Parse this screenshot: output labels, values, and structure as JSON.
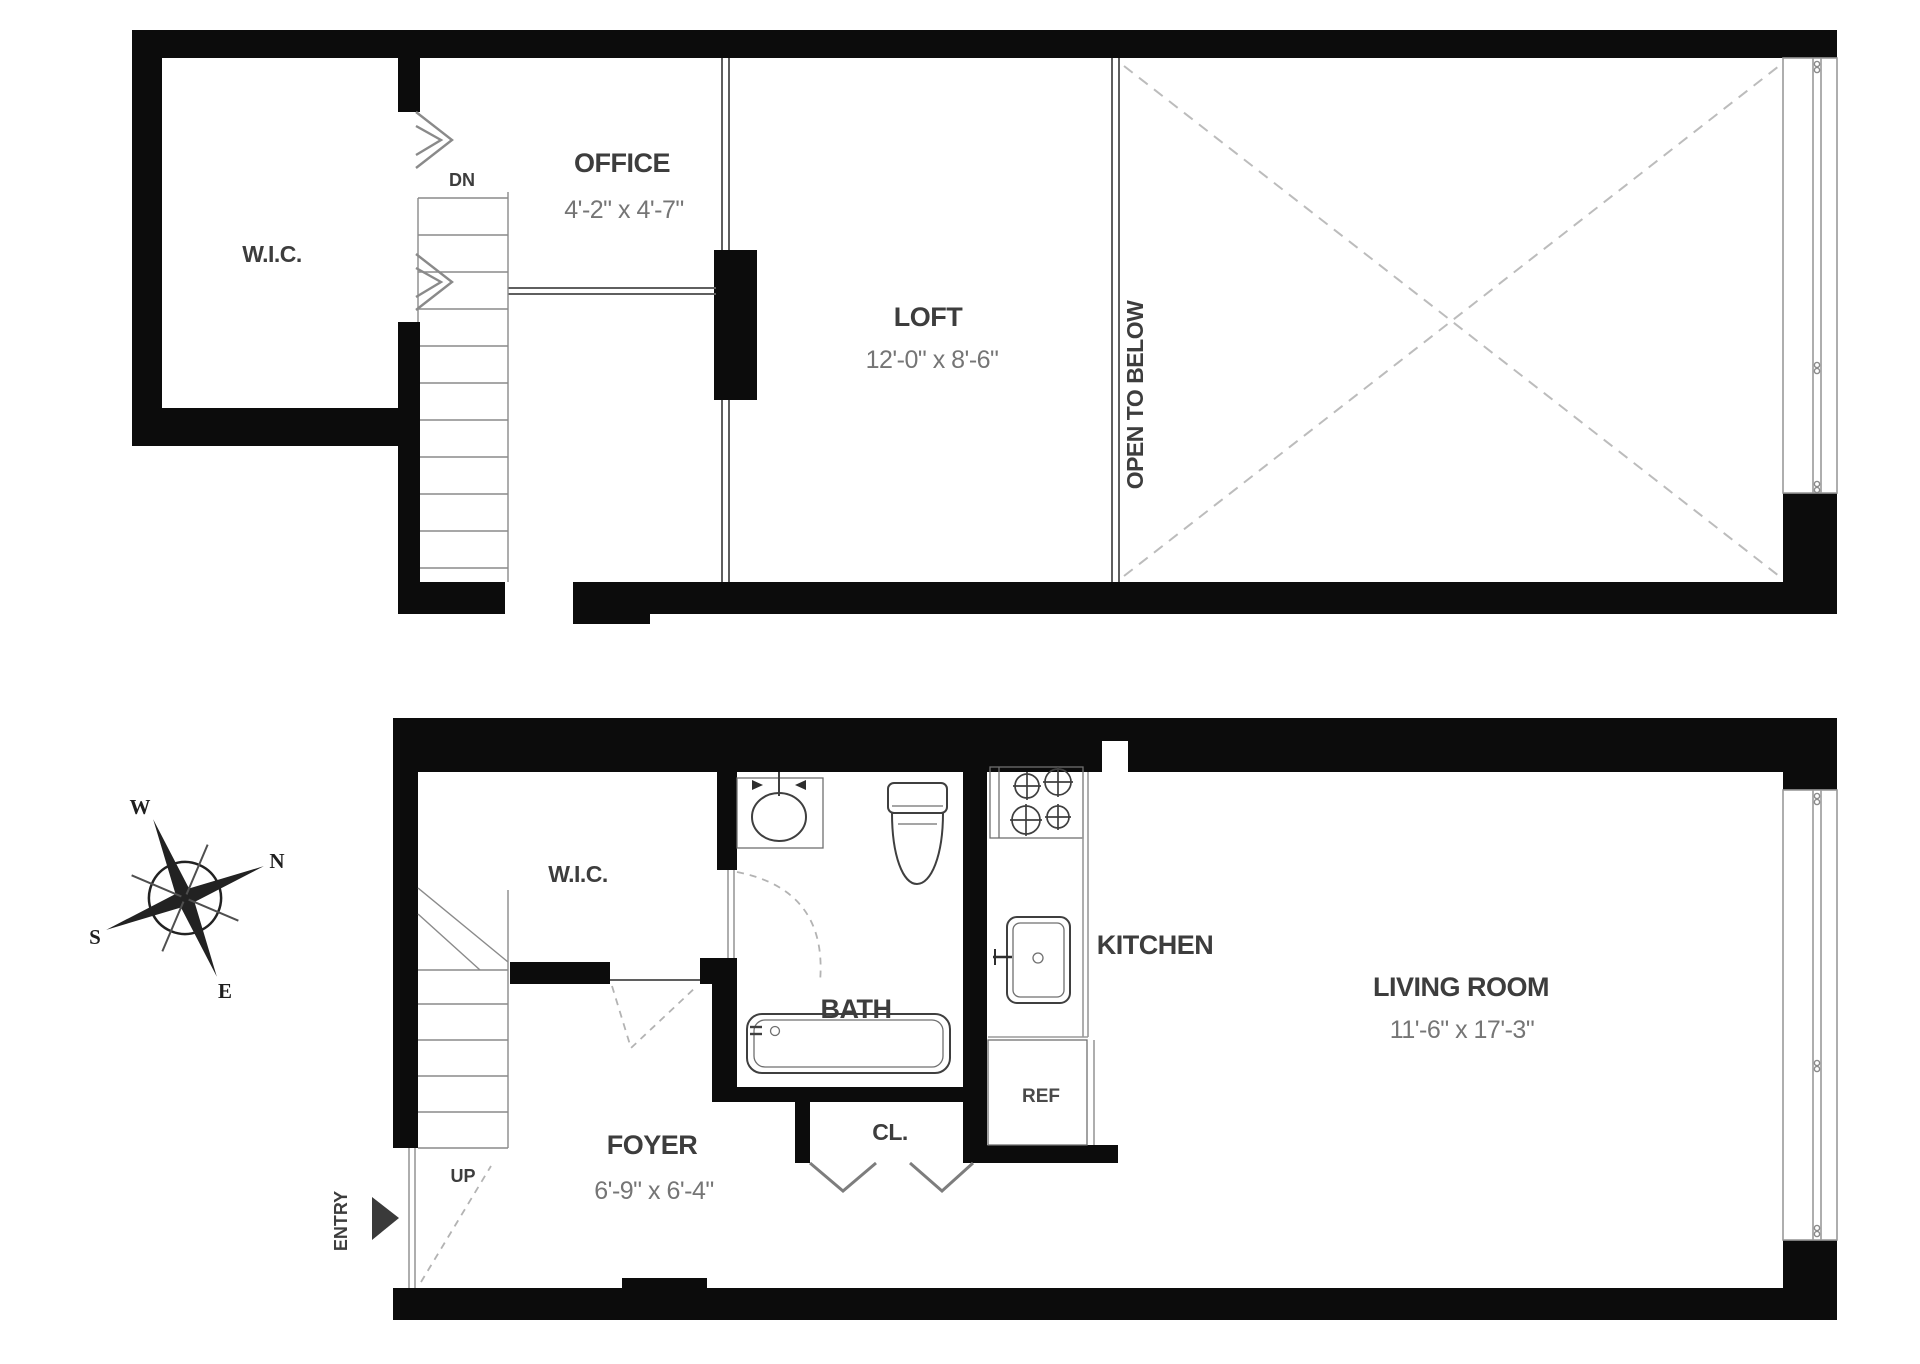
{
  "title": "Two-level apartment floor plan",
  "upper_floor": {
    "rooms": {
      "wic": {
        "label": "W.I.C."
      },
      "office": {
        "label": "OFFICE",
        "dimensions": "4'-2\" x 4'-7\""
      },
      "loft": {
        "label": "LOFT",
        "dimensions": "12'-0\" x 8'-6\""
      },
      "open_to_below": {
        "label": "OPEN TO BELOW"
      }
    },
    "stairs": {
      "label": "DN"
    }
  },
  "lower_floor": {
    "rooms": {
      "wic": {
        "label": "W.I.C."
      },
      "bath": {
        "label": "BATH"
      },
      "kitchen": {
        "label": "KITCHEN",
        "fridge_label": "REF"
      },
      "living_room": {
        "label": "LIVING ROOM",
        "dimensions": "11'-6\" x 17'-3\""
      },
      "foyer": {
        "label": "FOYER",
        "dimensions": "6'-9\" x 6'-4\""
      },
      "closet": {
        "label": "CL."
      }
    },
    "stairs": {
      "label": "UP"
    },
    "entry": {
      "label": "ENTRY"
    }
  },
  "compass": {
    "north": "N",
    "south": "S",
    "east": "E",
    "west": "W"
  },
  "colors": {
    "wall": "#0c0c0c",
    "thin_line": "#5f5f5f",
    "dashed_line": "#bcbcbc",
    "label_text": "#3d3d3d",
    "dimension_text": "#757575",
    "background": "#ffffff"
  }
}
